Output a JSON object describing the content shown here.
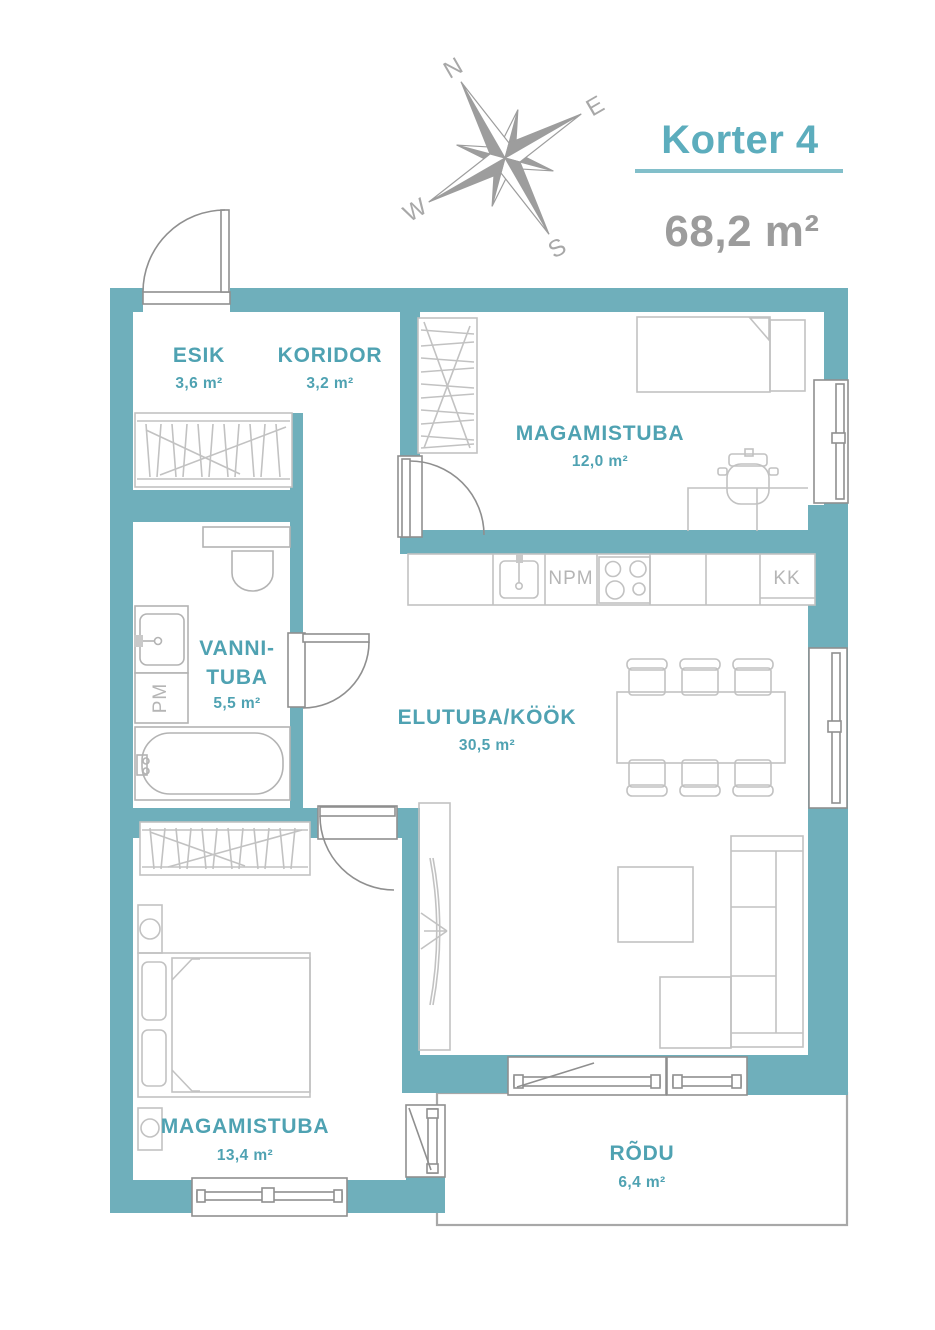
{
  "header": {
    "title": "Korter 4",
    "total_area": "68,2 m²"
  },
  "compass": {
    "north": "N",
    "east": "E",
    "south": "S",
    "west": "W"
  },
  "rooms": {
    "esik": {
      "name": "ESIK",
      "area": "3,6 m²"
    },
    "koridor": {
      "name": "KORIDOR",
      "area": "3,2 m²"
    },
    "magamistuba1": {
      "name": "MAGAMISTUBA",
      "area": "12,0 m²"
    },
    "vannituba": {
      "name_line1": "VANNI-",
      "name_line2": "TUBA",
      "area": "5,5 m²"
    },
    "elutuba": {
      "name": "ELUTUBA/KÖÖK",
      "area": "30,5 m²"
    },
    "magamistuba2": {
      "name": "MAGAMISTUBA",
      "area": "13,4 m²"
    },
    "rodu": {
      "name": "RÕDU",
      "area": "6,4 m²"
    }
  },
  "appliances": {
    "dishwasher": "NPM",
    "fridge": "KK",
    "washing_machine": "PM"
  },
  "colors": {
    "wall": "#6fafbb",
    "room_label": "#4fa2b2",
    "title": "#5cadbd",
    "underline": "#82bfca",
    "gray_text": "#9c9c9c",
    "furniture_stroke": "#c2c2c2",
    "opening_stroke": "#8f8f8f"
  }
}
